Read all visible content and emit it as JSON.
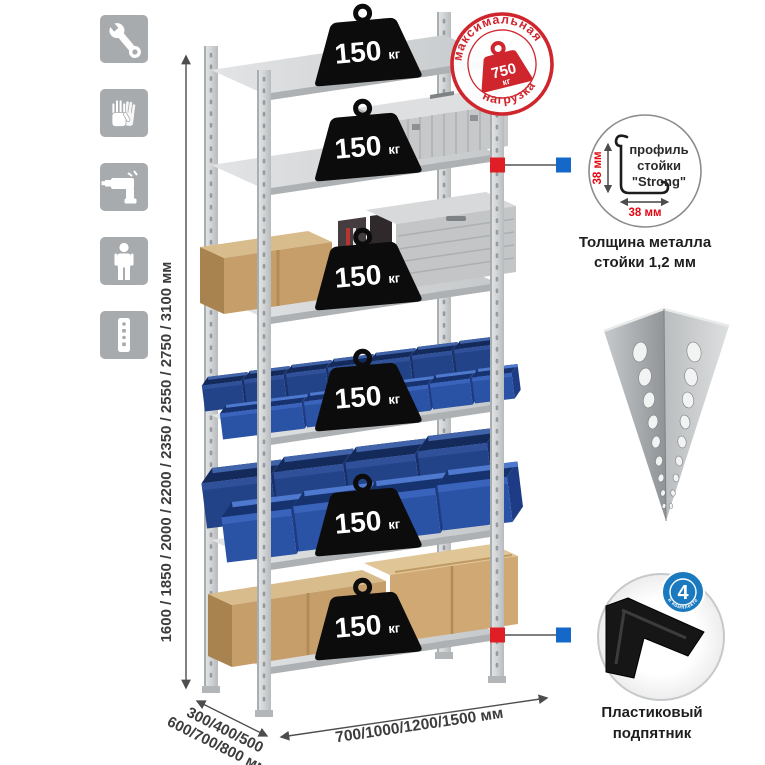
{
  "colors": {
    "stamp_red": "#cf262e",
    "marker_red": "#e01e26",
    "marker_blue": "#1468c8",
    "dim_red": "#e30613",
    "badge_blue": "#1b79bf",
    "bin_blue": "#2a52a5",
    "metal_gray": "#d8dadb",
    "icon_gray": "#a7abae",
    "cardboard": "#c59e6a",
    "text_dark": "#3c3c3c"
  },
  "sidebar_icons": [
    {
      "icon": "wrench-icon"
    },
    {
      "icon": "work-gloves-icon"
    },
    {
      "icon": "drill-icon"
    },
    {
      "icon": "person-icon"
    },
    {
      "icon": "upright-profile-icon"
    }
  ],
  "height_dimension": {
    "label": "1600 / 1850 / 2000 / 2200 / 2350 / 2550 / 2750 / 3100 мм"
  },
  "depth_dimension": {
    "line1": "300/400/500",
    "line2": "600/700/800 мм"
  },
  "width_dimension": {
    "label": "700/1000/1200/1500 мм"
  },
  "shelf_loads": [
    {
      "value": "150",
      "unit": "кг"
    },
    {
      "value": "150",
      "unit": "кг"
    },
    {
      "value": "150",
      "unit": "кг"
    },
    {
      "value": "150",
      "unit": "кг"
    },
    {
      "value": "150",
      "unit": "кг"
    },
    {
      "value": "150",
      "unit": "кг"
    }
  ],
  "max_load_stamp": {
    "arc_top": "максимальная",
    "arc_bottom": "нагрузка",
    "value": "750",
    "unit": "кг"
  },
  "profile_callout": {
    "vertical_dim": "38 мм",
    "horizontal_dim": "38 мм",
    "label_line1": "профиль",
    "label_line2": "стойки",
    "label_line3": "\"Strong\"",
    "caption_line1": "Толщина металла",
    "caption_line2": "стойки 1,2 мм"
  },
  "foot_callout": {
    "badge_value": "4",
    "badge_arc_text": "в комплекте",
    "caption_line1": "Пластиковый",
    "caption_line2": "подпятник"
  }
}
